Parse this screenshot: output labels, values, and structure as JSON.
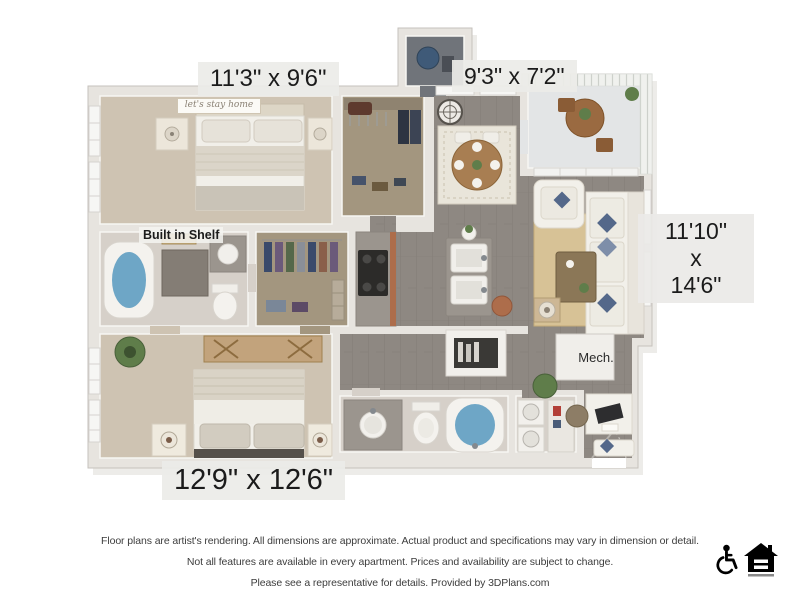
{
  "floor_plan": {
    "dimension_labels": {
      "bedroom1": "11'3\" x 9'6\"",
      "patio": "9'3\" x 7'2\"",
      "living_line1": "11'10\"",
      "living_line2": "x",
      "living_line3": "14'6\"",
      "bedroom2": "12'9\" x 12'6\""
    },
    "annotations": {
      "built_in_shelf": "Built in Shelf",
      "mech_closet": "Mech.",
      "wall_sign": "let's stay home"
    },
    "colors": {
      "wall": "#e7e4df",
      "carpet": "#cec3b2",
      "wood_floor": "#8e8882",
      "closet_floor": "#a3967f",
      "balcony_floor": "#e3e5e6",
      "tub_water": "#6ea6c6",
      "accent_pillow": "#54688a",
      "area_rug": "#d7c296",
      "cabinet_terracotta": "#ad6d4b",
      "countertop_granite": "#9b958e"
    }
  },
  "footer": {
    "line1": "Floor plans are artist's rendering. All dimensions are approximate. Actual product and specifications may vary in dimension or detail.",
    "line2": "Not all features are available in every apartment. Prices and availability are subject to change.",
    "line3": "Please see a representative for details. Provided by 3DPlans.com",
    "icons": [
      {
        "name": "wheelchair-accessible-icon"
      },
      {
        "name": "equal-housing-opportunity-icon"
      }
    ]
  }
}
